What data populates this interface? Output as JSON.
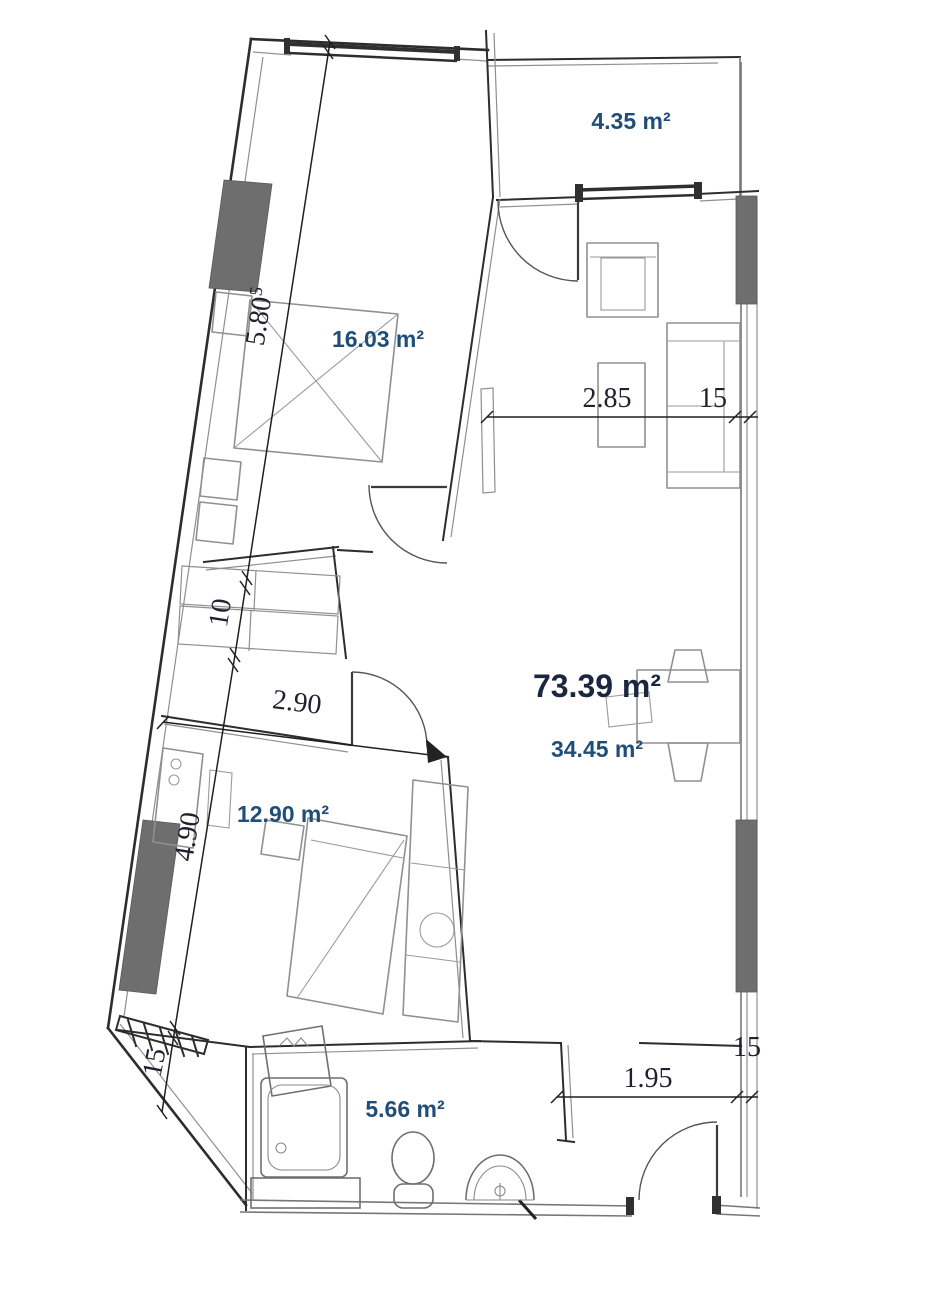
{
  "document": {
    "kind": "apartment floor plan"
  },
  "colors": {
    "background": "#ffffff",
    "area_label": "#1f4e79",
    "total_label": "#1b2740",
    "dimension_label": "#20202e",
    "wall": "#2d2d2d",
    "furniture": "#909090",
    "column_fill": "#6e6e6e"
  },
  "total": {
    "label": "73.39 m²"
  },
  "rooms": {
    "balcony": {
      "label": "4.35 m²"
    },
    "bedroom1": {
      "label": "16.03 m²"
    },
    "living": {
      "label": "34.45 m²"
    },
    "bedroom2": {
      "label": "12.90 m²"
    },
    "bathroom": {
      "label": "5.66 m²"
    }
  },
  "dims": {
    "len1": {
      "label": "5.80",
      "sup": "5"
    },
    "d10": {
      "label": "10"
    },
    "h490": {
      "label": "4.90"
    },
    "t15bl": {
      "label": "15"
    },
    "w285": {
      "label": "2.85"
    },
    "t15r": {
      "label": "15"
    },
    "w290": {
      "label": "2.90"
    },
    "w195": {
      "label": "1.95"
    },
    "t15br": {
      "label": "15"
    }
  }
}
